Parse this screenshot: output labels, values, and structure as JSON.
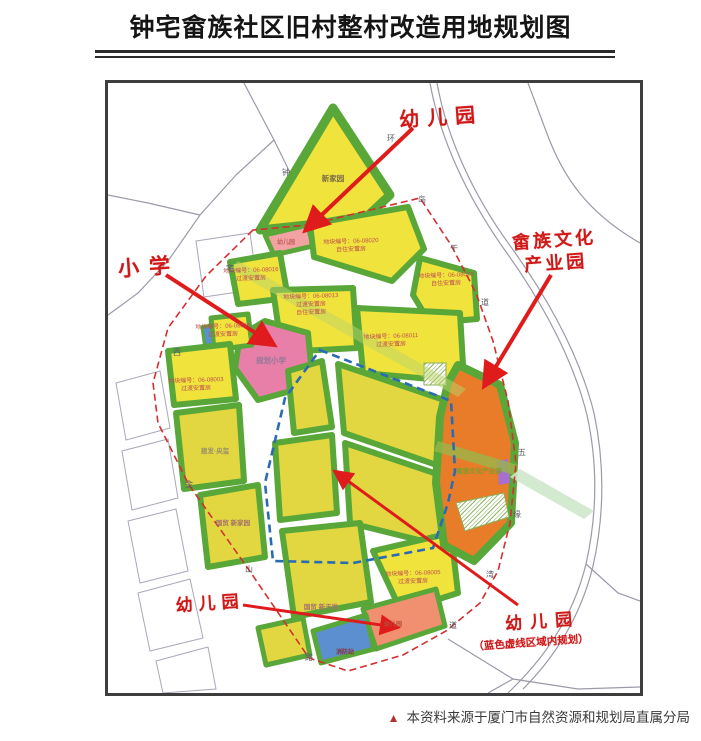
{
  "title": "钟宅畲族社区旧村整村改造用地规划图",
  "caption": {
    "marker": "▲",
    "text": "本资料来源于厦门市自然资源和规划局直属分局"
  },
  "annotations": {
    "kindergarten_top": "幼儿园",
    "primary_school": "小学",
    "culture_park_line1": "畲族文化",
    "culture_park_line2": "产业园",
    "kindergarten_bottom_left": "幼儿园",
    "kindergarten_bottom_right": "幼儿园",
    "kindergarten_note": "（蓝色虚线区域内规划）"
  },
  "map_labels": {
    "xinjiayuan": "新家园",
    "kindergarten_parcel_top": "幼儿园",
    "planned_primary_school": "规划小学",
    "culture_park": "畲族文化产业园",
    "jianfa_yangxi": "建发·央玺",
    "guomao_xinjiayuan": "国贸 新家园",
    "guomao_xintiandi": "国贸 新天地",
    "fire_station": "消防站",
    "kindergarten_parcel_bottom": "幼儿园"
  },
  "parcels": [
    {
      "lines": [
        "地块编号：06-08020",
        "自住安置房"
      ]
    },
    {
      "lines": [
        "地块编号：06-08023",
        "自住安置房"
      ]
    },
    {
      "lines": [
        "地块编号：06-08016",
        "过渡安置房"
      ]
    },
    {
      "lines": [
        "地块编号：06-08013",
        "过渡安置房",
        "自住安置房"
      ]
    },
    {
      "lines": [
        "地块编号：06-08011",
        "过渡安置房"
      ]
    },
    {
      "lines": [
        "地块编号：06-08003",
        "过渡安置房"
      ]
    },
    {
      "lines": [
        "地块编号：06-08015",
        "过渡安置房"
      ]
    },
    {
      "lines": [
        "地块编号：06-08005",
        "过渡安置房"
      ]
    }
  ],
  "roads": {
    "zhongzhai": [
      "钟",
      "宅",
      "西"
    ],
    "huandao": [
      "环",
      "岛",
      "干",
      "道"
    ],
    "jinshan": [
      "金",
      "山",
      "路"
    ],
    "wuyuanwan": [
      "五",
      "缘",
      "湾",
      "道"
    ]
  },
  "colors": {
    "parcel_yellow": "#f0e33c",
    "parcel_olive": "#e2d741",
    "green_edge": "#58a738",
    "school_pink": "#e87fa8",
    "kindergarten_pink": "#f2a2a2",
    "kindergarten_salmon": "#f09070",
    "culture_orange": "#e87c28",
    "fire_blue": "#5b8fd0",
    "purple_lot": "#a76fd0",
    "red_annotation": "#d01818",
    "red_boundary": "#d23030",
    "blue_boundary": "#2a6bb5"
  }
}
